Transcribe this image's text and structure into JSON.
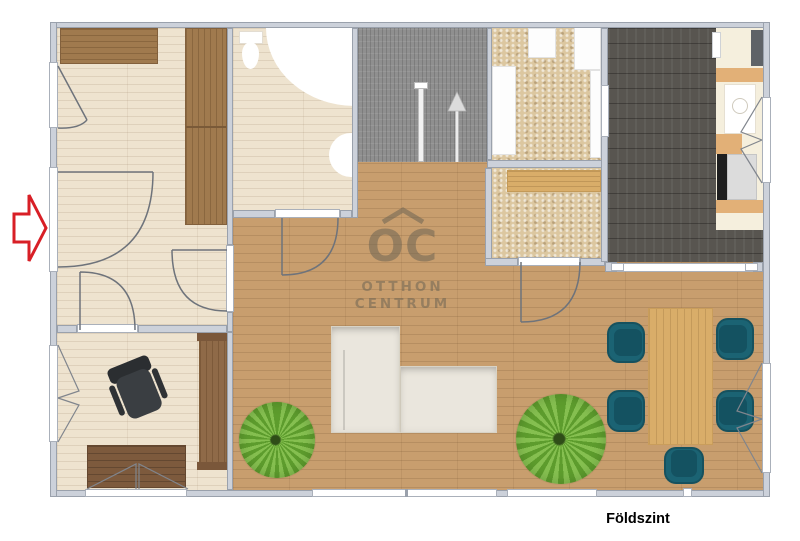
{
  "caption": {
    "label": "Földszint"
  },
  "watermark": {
    "monogram": "OC",
    "line1": "OTTHON",
    "line2": "CENTRUM"
  },
  "icons": {
    "entrance": "entrance-arrow-icon",
    "stairs_direction": "stairs-up-arrow-icon",
    "watermark_roof": "roof-chevron-icon"
  },
  "legend_colors": {
    "wall": "#ccd1da",
    "wall_border": "#9aa1ac",
    "floor_light": "#eee3cf",
    "floor_oak": "#c89e6e",
    "floor_dark": "#585550",
    "floor_stone": "#dcc7a0",
    "stairs": "#8f8f8f",
    "accent_red": "#d81f26",
    "chair_teal": "#1b6373",
    "chair_teal_dark": "#145261",
    "plant": "#5d9c2d",
    "sofa": "#eae6dd",
    "table_oak": "#d9ad69",
    "furniture_brown": "#a07a4e",
    "desk_brown": "#7d5a3d",
    "counter_cream": "#f5efdd",
    "watermark": "#6f6554"
  }
}
